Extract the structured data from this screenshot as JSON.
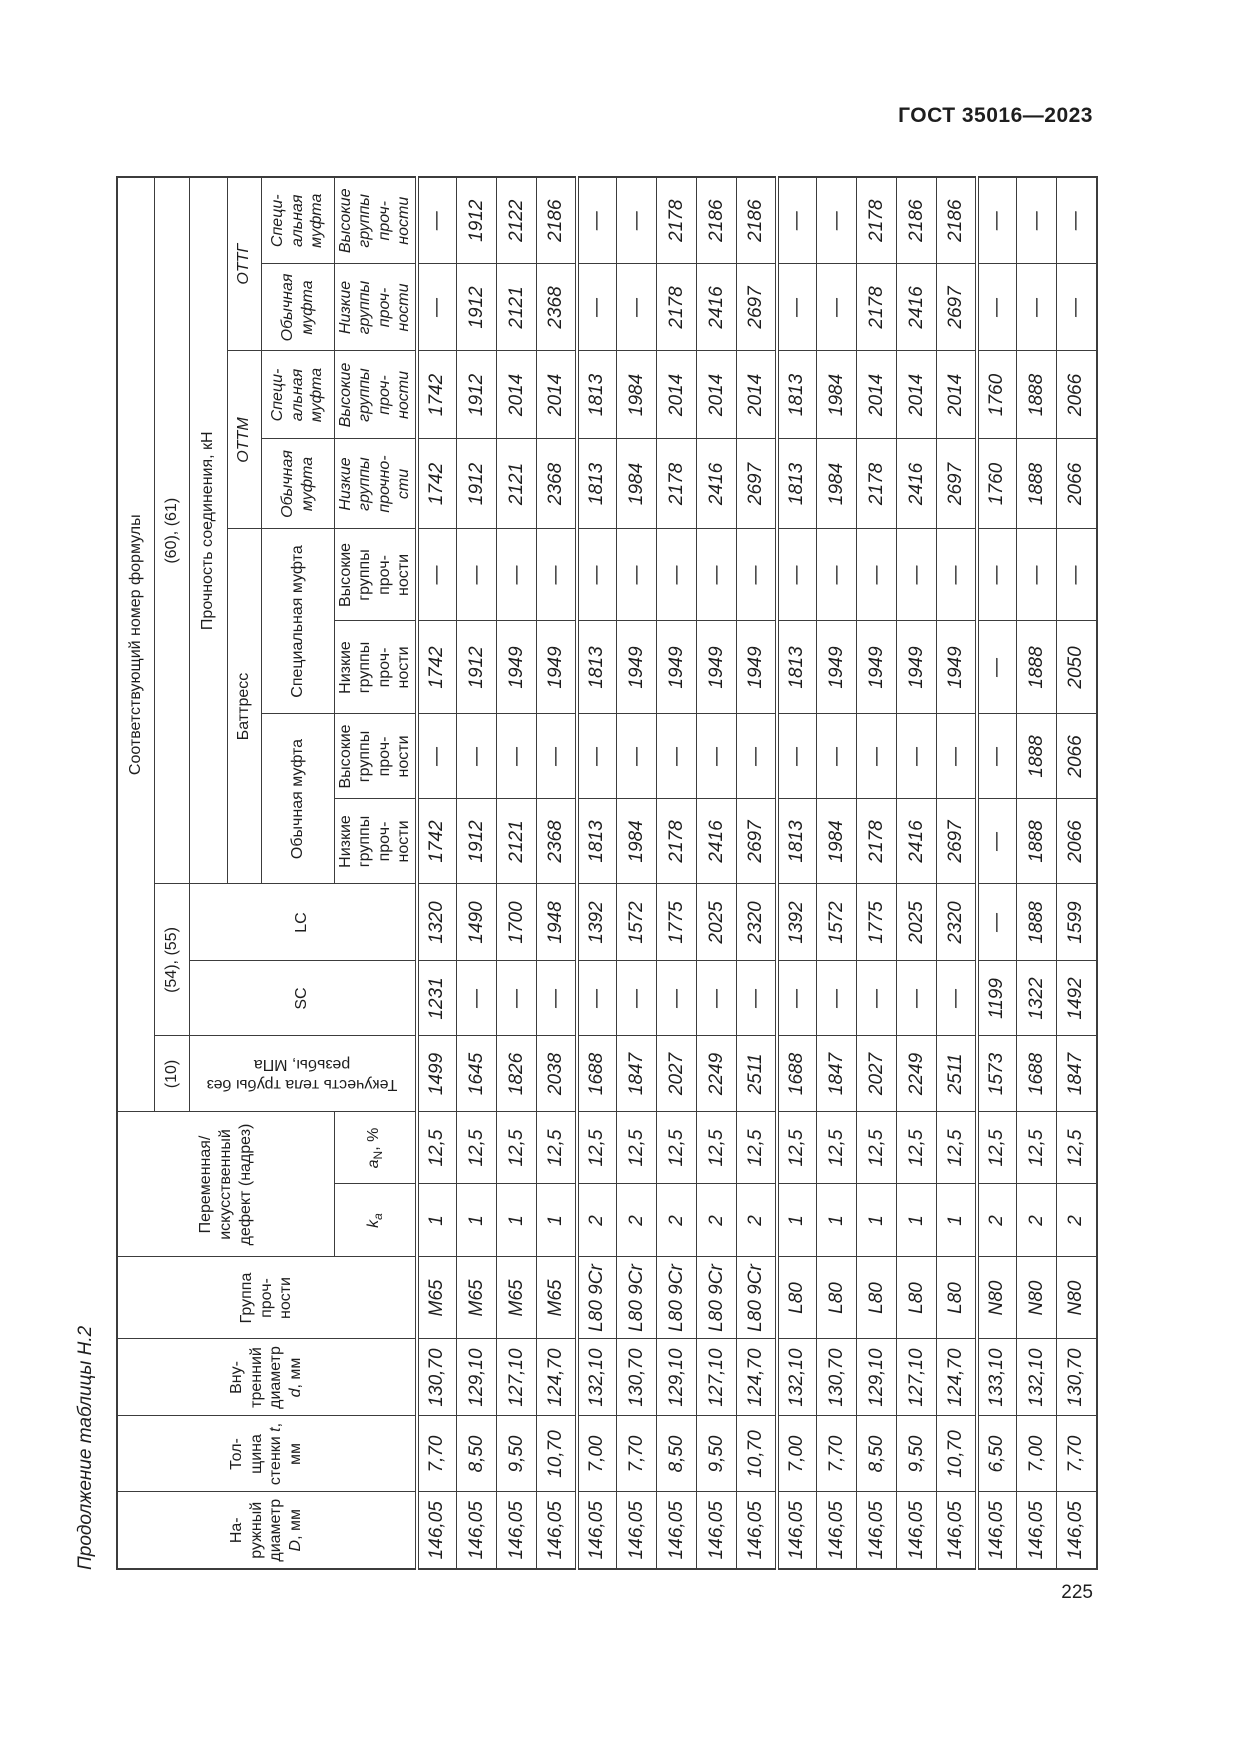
{
  "page": {
    "standard": "ГОСТ 35016—2023",
    "number": "225",
    "caption": "Продолжение таблицы Н.2"
  },
  "table": {
    "col_headers": {
      "outer_diameter": {
        "lines": "На-\nружный\nдиаметр",
        "symbol": "D",
        "unit": ", мм"
      },
      "wall_thickness": {
        "line1": "Тол-\nщина",
        "pre": "стенки ",
        "symbol": "t",
        "post": ",",
        "unit": "мм"
      },
      "inner_diameter": {
        "lines": "Вну-\nтренний\nдиаметр",
        "symbol": "d",
        "unit": ", мм"
      },
      "strength_group": "Группа\nпроч-\nности",
      "defect": "Переменная/\nискусственный\nдефект (надрез)",
      "k_symbol": "k",
      "k_sub": "a",
      "a_symbol": "a",
      "a_sub": "N",
      "a_unit": ", %",
      "yield": "Текучесть тела трубы без\nрезьбы, МПа",
      "sc": "SC",
      "lc": "LC"
    },
    "formula_header": "Соответствующий номер формулы",
    "formulas": {
      "yield": "(10)",
      "sc_lc": "(54), (55)",
      "joint": "(60), (61)"
    },
    "joint_strength": "Прочность соединения, кН",
    "groups": {
      "buttress": "Баттресс",
      "ottm": "ОТТМ",
      "ottg": "ОТТГ"
    },
    "couplings": {
      "buttress_regular": "Обычная муфта",
      "buttress_special": "Специальная муфта",
      "regular_wrapped": "Обычная\nмуфта",
      "special_wrapped": "Специ-\nальная\nмуфта"
    },
    "subgroups": {
      "low": "Низкие\nгруппы\nпроч-\nности",
      "high": "Высокие\nгруппы\nпроч-\nности",
      "low_ottm": "Низкие\nгруппы\nпрочно-\nсти"
    },
    "column_keys": [
      "outer_diameter_D_mm",
      "wall_thickness_t_mm",
      "inner_diameter_d_mm",
      "strength_group",
      "k_a",
      "a_N_percent",
      "pipe_body_yield_MPa",
      "SC",
      "LC",
      "buttress_regular_low",
      "buttress_regular_high",
      "buttress_special_low",
      "buttress_special_high",
      "ottm_regular_low",
      "ottm_special_high",
      "ottg_regular_low",
      "ottg_special_high"
    ],
    "group_separator_rows": [
      4,
      9,
      14
    ],
    "rows": [
      [
        "146,05",
        "7,70",
        "130,70",
        "М65",
        "1",
        "12,5",
        "1499",
        "1231",
        "1320",
        "1742",
        "—",
        "1742",
        "—",
        "1742",
        "1742",
        "—",
        "—"
      ],
      [
        "146,05",
        "8,50",
        "129,10",
        "М65",
        "1",
        "12,5",
        "1645",
        "—",
        "1490",
        "1912",
        "—",
        "1912",
        "—",
        "1912",
        "1912",
        "1912",
        "1912"
      ],
      [
        "146,05",
        "9,50",
        "127,10",
        "М65",
        "1",
        "12,5",
        "1826",
        "—",
        "1700",
        "2121",
        "—",
        "1949",
        "—",
        "2121",
        "2014",
        "2121",
        "2122"
      ],
      [
        "146,05",
        "10,70",
        "124,70",
        "М65",
        "1",
        "12,5",
        "2038",
        "—",
        "1948",
        "2368",
        "—",
        "1949",
        "—",
        "2368",
        "2014",
        "2368",
        "2186"
      ],
      [
        "146,05",
        "7,00",
        "132,10",
        "L80 9Cr",
        "2",
        "12,5",
        "1688",
        "—",
        "1392",
        "1813",
        "—",
        "1813",
        "—",
        "1813",
        "1813",
        "—",
        "—"
      ],
      [
        "146,05",
        "7,70",
        "130,70",
        "L80 9Cr",
        "2",
        "12,5",
        "1847",
        "—",
        "1572",
        "1984",
        "—",
        "1949",
        "—",
        "1984",
        "1984",
        "—",
        "—"
      ],
      [
        "146,05",
        "8,50",
        "129,10",
        "L80 9Cr",
        "2",
        "12,5",
        "2027",
        "—",
        "1775",
        "2178",
        "—",
        "1949",
        "—",
        "2178",
        "2014",
        "2178",
        "2178"
      ],
      [
        "146,05",
        "9,50",
        "127,10",
        "L80 9Cr",
        "2",
        "12,5",
        "2249",
        "—",
        "2025",
        "2416",
        "—",
        "1949",
        "—",
        "2416",
        "2014",
        "2416",
        "2186"
      ],
      [
        "146,05",
        "10,70",
        "124,70",
        "L80 9Cr",
        "2",
        "12,5",
        "2511",
        "—",
        "2320",
        "2697",
        "—",
        "1949",
        "—",
        "2697",
        "2014",
        "2697",
        "2186"
      ],
      [
        "146,05",
        "7,00",
        "132,10",
        "L80",
        "1",
        "12,5",
        "1688",
        "—",
        "1392",
        "1813",
        "—",
        "1813",
        "—",
        "1813",
        "1813",
        "—",
        "—"
      ],
      [
        "146,05",
        "7,70",
        "130,70",
        "L80",
        "1",
        "12,5",
        "1847",
        "—",
        "1572",
        "1984",
        "—",
        "1949",
        "—",
        "1984",
        "1984",
        "—",
        "—"
      ],
      [
        "146,05",
        "8,50",
        "129,10",
        "L80",
        "1",
        "12,5",
        "2027",
        "—",
        "1775",
        "2178",
        "—",
        "1949",
        "—",
        "2178",
        "2014",
        "2178",
        "2178"
      ],
      [
        "146,05",
        "9,50",
        "127,10",
        "L80",
        "1",
        "12,5",
        "2249",
        "—",
        "2025",
        "2416",
        "—",
        "1949",
        "—",
        "2416",
        "2014",
        "2416",
        "2186"
      ],
      [
        "146,05",
        "10,70",
        "124,70",
        "L80",
        "1",
        "12,5",
        "2511",
        "—",
        "2320",
        "2697",
        "—",
        "1949",
        "—",
        "2697",
        "2014",
        "2697",
        "2186"
      ],
      [
        "146,05",
        "6,50",
        "133,10",
        "N80",
        "2",
        "12,5",
        "1573",
        "1199",
        "—",
        "—",
        "—",
        "—",
        "—",
        "1760",
        "1760",
        "—",
        "—"
      ],
      [
        "146,05",
        "7,00",
        "132,10",
        "N80",
        "2",
        "12,5",
        "1688",
        "1322",
        "1888",
        "1888",
        "1888",
        "1888",
        "—",
        "1888",
        "1888",
        "—",
        "—"
      ],
      [
        "146,05",
        "7,70",
        "130,70",
        "N80",
        "2",
        "12,5",
        "1847",
        "1492",
        "1599",
        "2066",
        "2066",
        "2050",
        "—",
        "2066",
        "2066",
        "—",
        "—"
      ]
    ]
  }
}
